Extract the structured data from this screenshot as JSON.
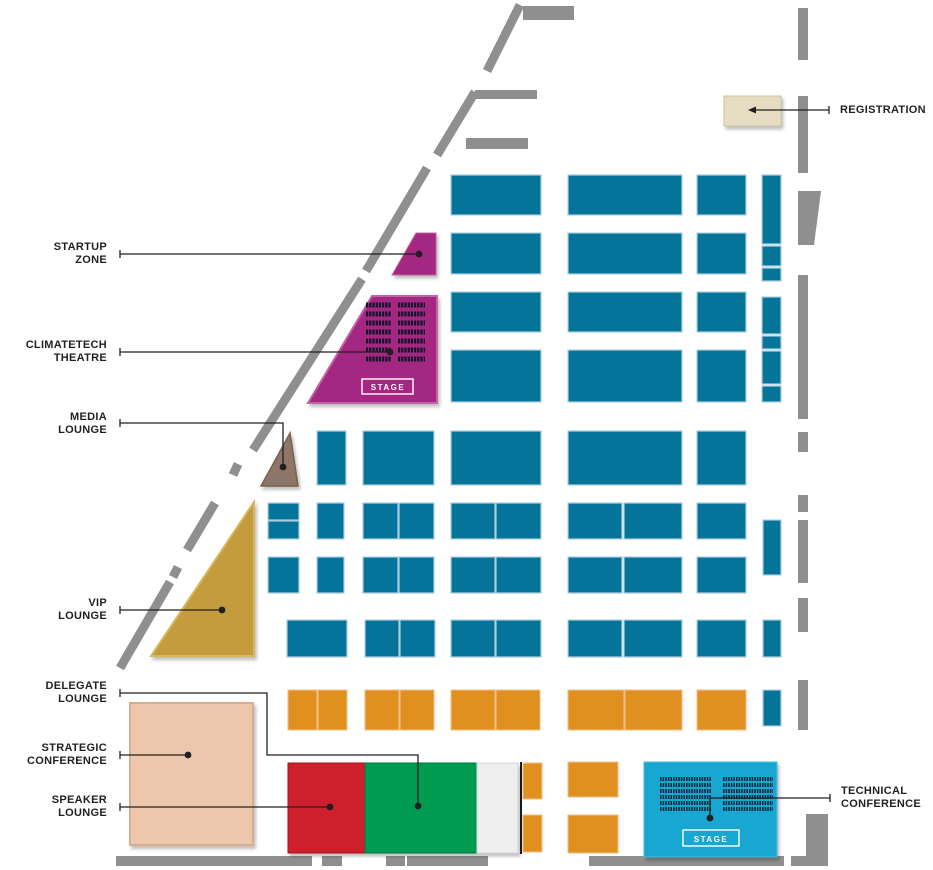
{
  "palette": {
    "booth_blue": "#04749B",
    "booth_orange": "#E0901E",
    "wall_gray": "#8F8F8F",
    "leader_black": "#231F20",
    "theatre_seat_dark": "#15142A",
    "tech_seat_dark": "#0D2B40"
  },
  "zones": {
    "registration": {
      "label": "REGISTRATION",
      "color": "#E5DCC1"
    },
    "startup_zone": {
      "label": "STARTUP\nZONE",
      "color": "#A42781"
    },
    "climatetech_theatre": {
      "label": "CLIMATETECH\nTHEATRE",
      "color": "#A42781",
      "stage_label": "STAGE"
    },
    "media_lounge": {
      "label": "MEDIA\nLOUNGE",
      "color": "#8D7568"
    },
    "vip_lounge": {
      "label": "VIP\nLOUNGE",
      "color": "#C49C3E"
    },
    "delegate_lounge": {
      "label": "DELEGATE\nLOUNGE",
      "color": "#009B50"
    },
    "strategic_conference": {
      "label": "STRATEGIC\nCONFERENCE",
      "color": "#ECC7AC"
    },
    "speaker_lounge": {
      "label": "SPEAKER\nLOUNGE",
      "color": "#CE202C"
    },
    "technical_conference": {
      "label": "TECHNICAL\nCONFERENCE",
      "color": "#17A7D0",
      "stage_label": "STAGE"
    },
    "aux_room": {
      "color": "#EDEEED"
    }
  }
}
